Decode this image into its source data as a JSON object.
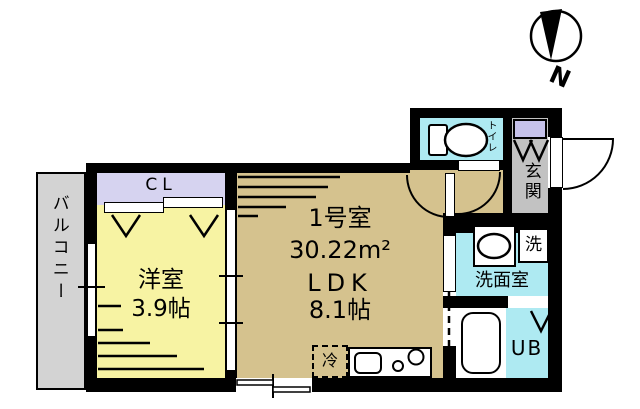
{
  "plan": {
    "compass_north": "N",
    "balcony": {
      "label": "バルコニー"
    },
    "closet": {
      "label": "CL"
    },
    "western_room": {
      "name": "洋室",
      "size": "3.9帖"
    },
    "ldk": {
      "unit": "1号室",
      "area": "30.22m²",
      "name": "LDK",
      "size": "8.1帖"
    },
    "toilet": {
      "label": "トイレ"
    },
    "entrance": {
      "label": "玄関"
    },
    "washroom": {
      "label": "洗面室"
    },
    "washer": {
      "label": "洗"
    },
    "unit_bath": {
      "label": "UB"
    },
    "fridge": {
      "label": "冷"
    }
  },
  "colors": {
    "wall": "#000000",
    "ldk_floor": "#d5c28e",
    "western_room_floor": "#f7f3a3",
    "closet_floor": "#d6d3f0",
    "wet_area_floor": "#aeeaf2",
    "entrance_floor": "#c2c2c2",
    "balcony_floor": "#d3d3d3",
    "shoe_cabinet": "#c6c2ea"
  }
}
